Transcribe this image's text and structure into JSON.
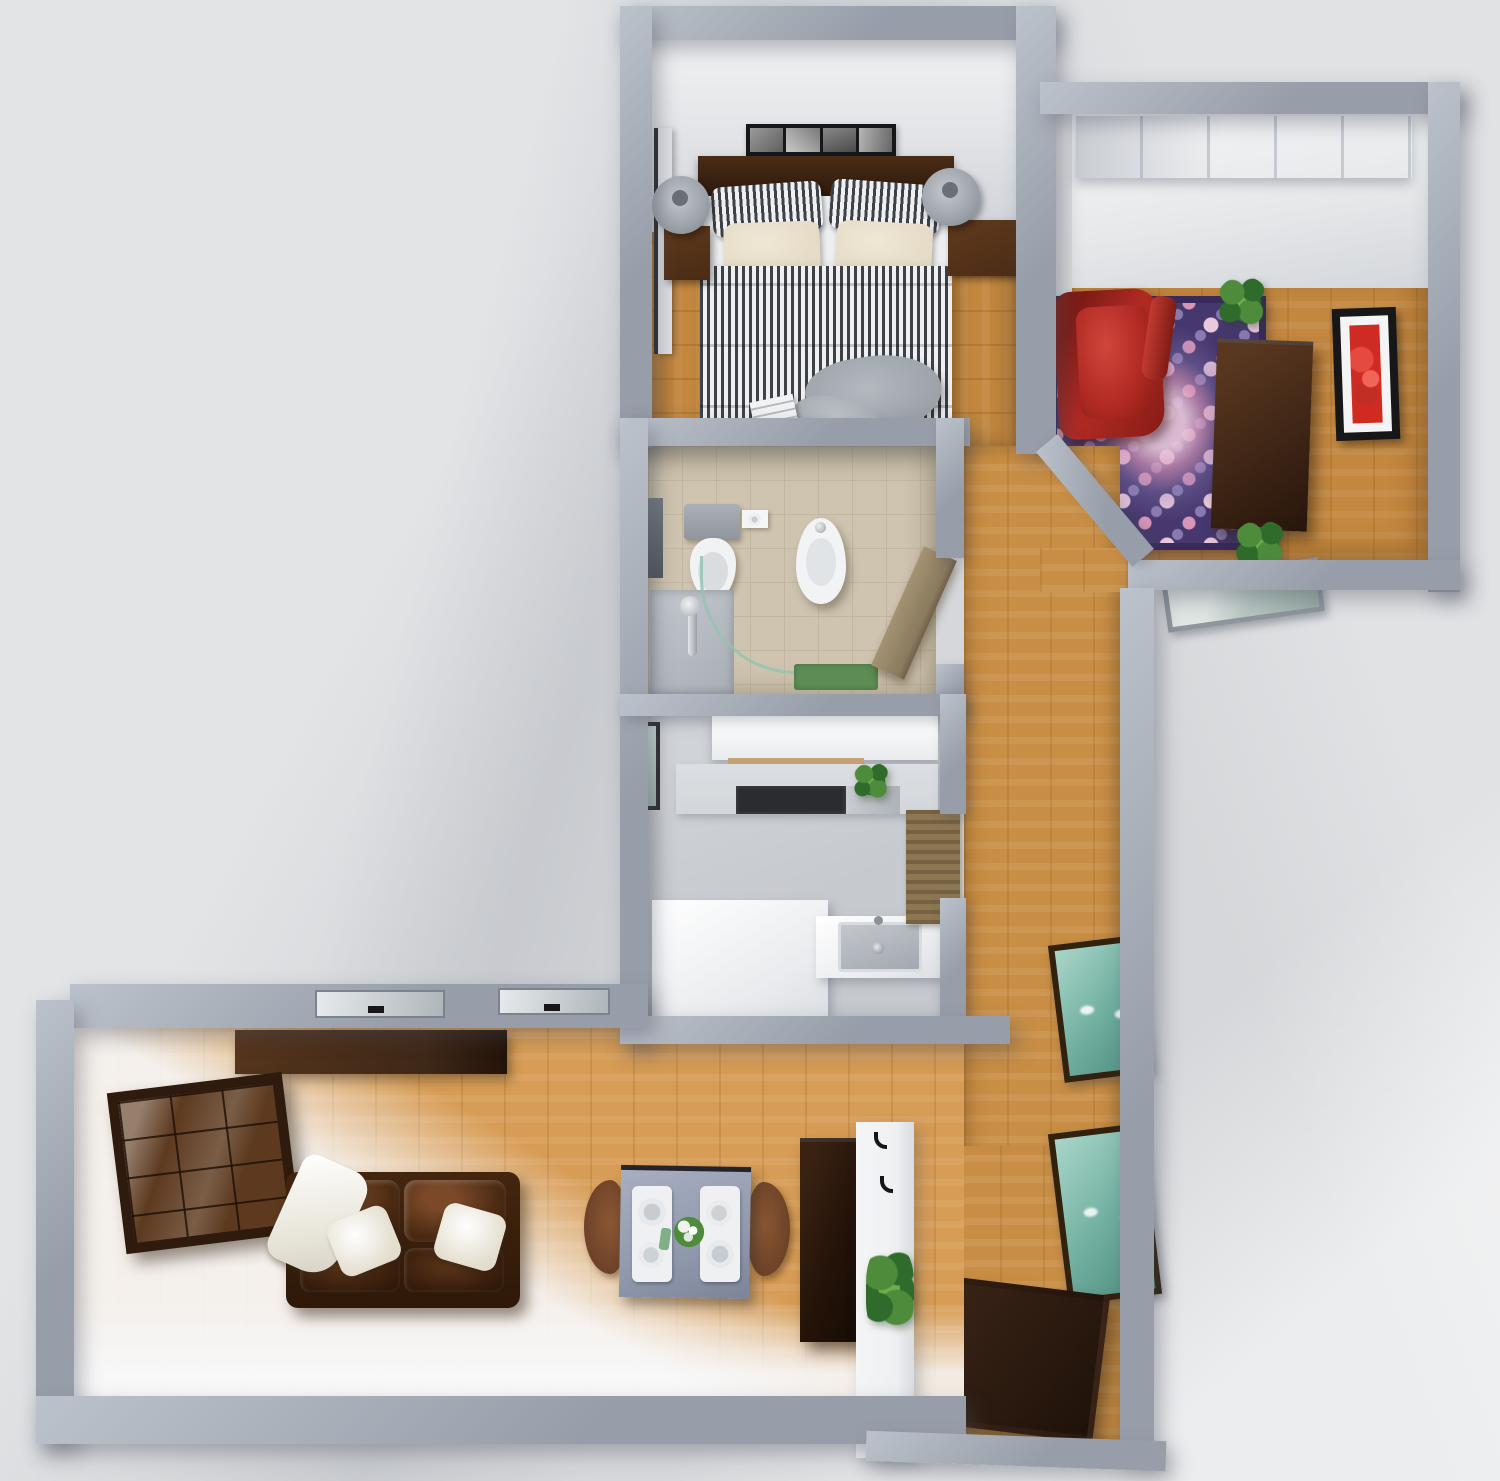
{
  "scene": {
    "kind": "3d-floorplan-top-down-render",
    "apartment": "one-bedroom apartment, dollhouse top view, no text labels visible"
  },
  "colors": {
    "bg": "#d5d7da",
    "bgLight": "#e7e9eb",
    "wall": "#989ea9",
    "wallTop": "#bcc2cb",
    "innerWhite": "#eef0f2",
    "woodBedroom": "#c3873f",
    "woodHall": "#c98e45",
    "woodLiving": "#d79c55",
    "tile": "#cfc4af",
    "kitchenFloor": "#c6c9ce",
    "counterWhite": "#f3f4f6",
    "counterTop": "#d3d6da",
    "cooktop": "#2b2c30",
    "sink": "#a2a8b0",
    "teal": "#6fae9f",
    "frameDark": "#31210f",
    "doorWood": "#2e1c11",
    "chest": "#452a18",
    "shelfWood": "#3f2817",
    "cabinetWood": "#2e1b0e",
    "cabinetGlass": "#5d3a1f",
    "sofaLeather": "#44260f",
    "sofaLeatherDark": "#2e1808",
    "cream": "#e5dbc6",
    "stripeDark": "#3e4147",
    "stripeLight": "#eff0f2",
    "lampGray": "#9ba1a9",
    "headboard": "#2a170b",
    "nightstand": "#4a2b15",
    "rugBase": "#46386f",
    "rugBorder": "#382b5c",
    "rugPink": "#d795b8",
    "rugLightPink": "#e9c8dc",
    "red": "#b02a23",
    "redDeep": "#871c16",
    "green": "#4e8c3c",
    "greenDeep": "#2f6b2a",
    "matGreen": "#5d8d55",
    "runner": "#8d7752",
    "tableTop": "#9099ae",
    "chairWood": "#6e4228",
    "tallCabinet": "#241309",
    "blanketGray": "#9aa1a7",
    "white": "#ffffff",
    "black": "#17171a"
  },
  "rooms": {
    "bedroom": {
      "name": "bedroom",
      "floor": "wood",
      "items": [
        "wall-art-strip",
        "headboard",
        "double-bed",
        "striped-pillows",
        "cream-pillows",
        "striped-duvet",
        "gray-blanket",
        "magazine",
        "nightstand-left",
        "nightstand-right",
        "bedside-lamp-left",
        "bedside-lamp-right",
        "open-door-panel"
      ]
    },
    "dressing_room": {
      "name": "dressing-room",
      "floor": "wood",
      "items": [
        "sliding-wardrobe",
        "ornate-rug",
        "red-armchair",
        "storage-chest",
        "red-wall-art",
        "potted-plant-top",
        "potted-plant-bottom",
        "bottom-wall-window"
      ]
    },
    "bathroom": {
      "name": "bathroom",
      "floor": "tile",
      "items": [
        "toilet",
        "toilet-paper-holder",
        "bidet",
        "shower-tray",
        "shower-glass",
        "mirror",
        "bath-mat",
        "open-door"
      ]
    },
    "kitchen": {
      "name": "kitchen",
      "floor": "gray",
      "items": [
        "upper-cabinets",
        "counter-with-cooktop",
        "counter-plant",
        "l-shaped-counter",
        "sink",
        "left-wall-window"
      ]
    },
    "hallway": {
      "name": "hallway",
      "floor": "wood",
      "items": [
        "woven-runner-mat",
        "teal-window-upper",
        "teal-window-lower",
        "entry-door-open",
        "bottom-window-pane"
      ]
    },
    "living_room": {
      "name": "living-room",
      "floor": "wood",
      "items": [
        "glass-display-cabinet",
        "wall-shelf",
        "leather-sofa",
        "white-throw-pillow-left",
        "white-throw-pillow-right",
        "white-throw-blanket",
        "dining-table",
        "place-setting-left",
        "place-setting-right",
        "table-flowers",
        "dining-chair-left",
        "dining-chair-right",
        "tall-cabinet",
        "coat-hooks",
        "partition-plant",
        "skylight-window-left",
        "skylight-window-right"
      ]
    }
  }
}
